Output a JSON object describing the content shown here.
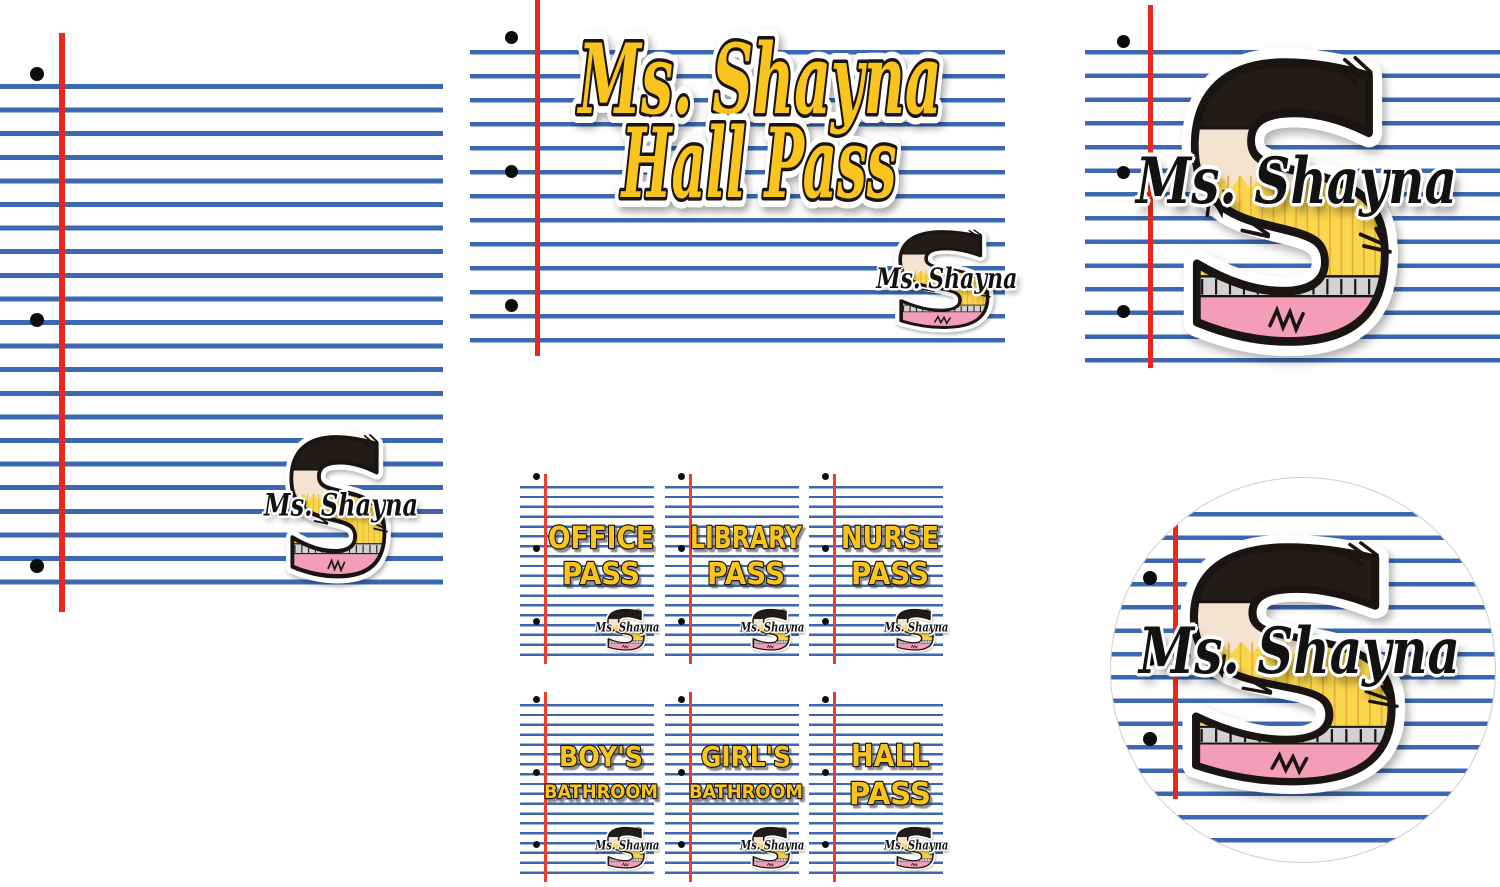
{
  "teacher": {
    "name": "Ms. Shayna"
  },
  "logo": {
    "letter": "S",
    "label": "Ms. Shayna"
  },
  "cover": {
    "line1": "Ms. Shayna",
    "line2": "Hall Pass"
  },
  "cards": [
    {
      "id": "office-pass",
      "line1": "OFFICE",
      "line2": "PASS"
    },
    {
      "id": "library-pass",
      "line1": "LIBRARY",
      "line2": "PASS"
    },
    {
      "id": "nurse-pass",
      "line1": "NURSE",
      "line2": "PASS"
    },
    {
      "id": "boys-bathroom",
      "line1": "BOY'S",
      "line2": "BATHROOM"
    },
    {
      "id": "girls-bathroom",
      "line1": "GIRL'S",
      "line2": "BATHROOM"
    },
    {
      "id": "hall-pass",
      "line1": "HALL",
      "line2": "PASS"
    }
  ],
  "colors": {
    "rule_blue": "#3a68b2",
    "margin_red": "#e8281c",
    "card_margin_red": "#ef3d2c",
    "hole_black": "#0c0c0c",
    "lettering_yellow": "#f9c41d",
    "outline_black": "#1a1512",
    "pencil_top_black": "#221c19",
    "pencil_wood_cream": "#f5e3d2",
    "pencil_body_yellow": "#f8d74b",
    "pencil_stripe_orange": "#e9ad3e",
    "pencil_ferrule_gray": "#d2d2d2",
    "pencil_eraser_pink": "#f49db9"
  }
}
